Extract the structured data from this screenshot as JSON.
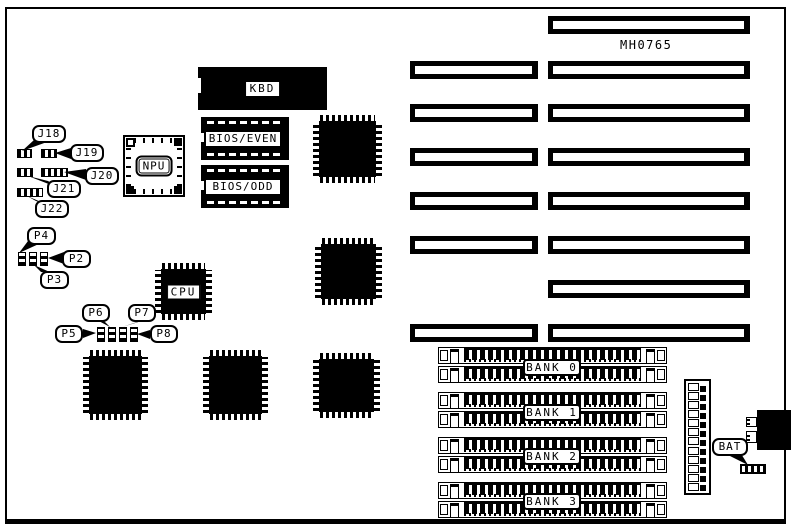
{
  "diagram": {
    "part_number": "MH0765"
  },
  "components": {
    "kbd_label": "KBD",
    "bios_even_label": "BIOS/EVEN",
    "bios_odd_label": "BIOS/ODD",
    "npu_label": "NPU",
    "cpu_label": "CPU",
    "bat_label": "BAT"
  },
  "jumper_callouts": {
    "J18": "J18",
    "J19": "J19",
    "J20": "J20",
    "J21": "J21",
    "J22": "J22",
    "P2": "P2",
    "P3": "P3",
    "P4": "P4",
    "P5": "P5",
    "P6": "P6",
    "P7": "P7",
    "P8": "P8"
  },
  "memory": {
    "bank_labels": [
      "BANK 0",
      "BANK 1",
      "BANK 2",
      "BANK 3"
    ],
    "sockets_per_bank": 2
  },
  "expansion_slots": {
    "right_column_count": 8,
    "left_column_count": 6
  },
  "power_connector": {
    "pin_count": 12
  },
  "colors": {
    "ink": "#000000",
    "paper": "#ffffff"
  }
}
